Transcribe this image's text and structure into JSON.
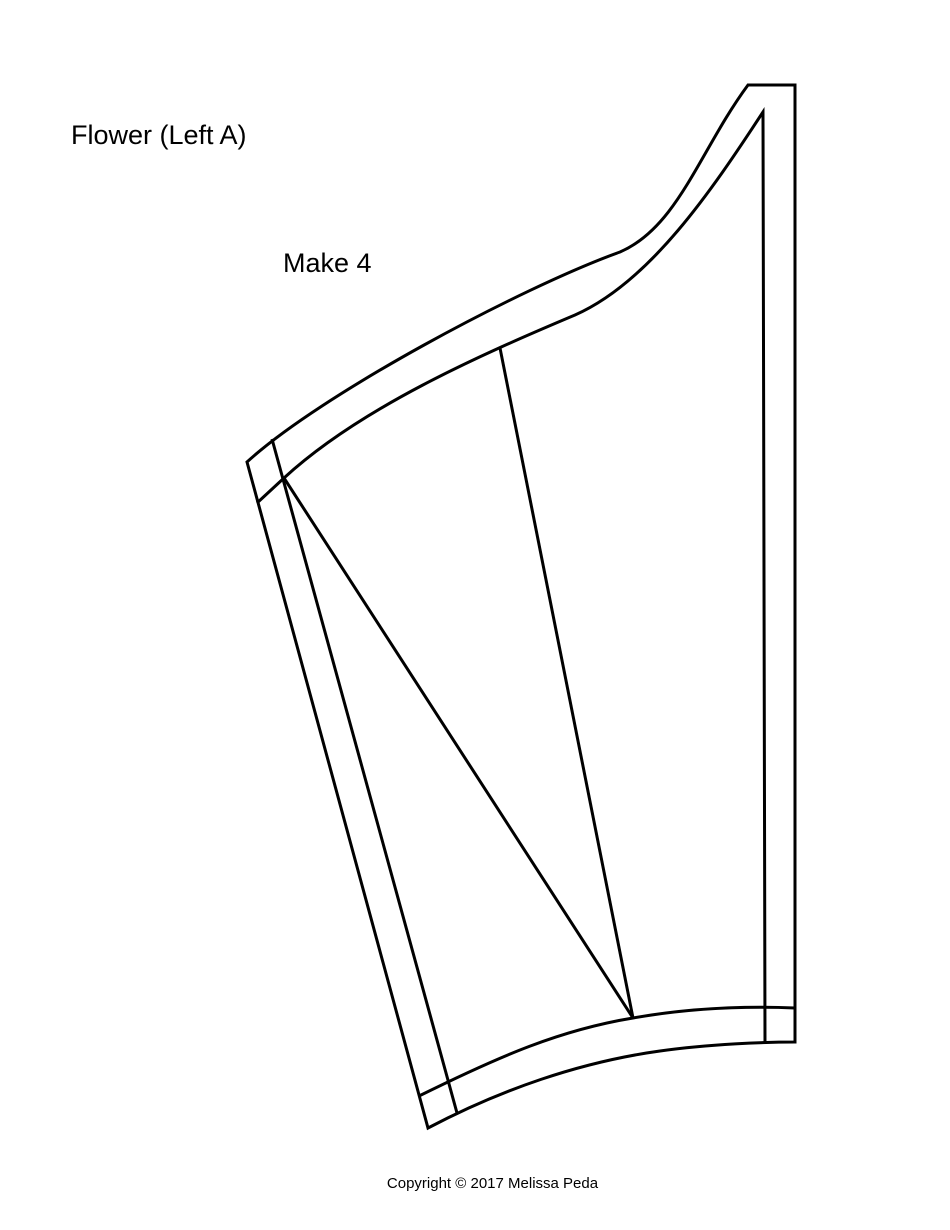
{
  "page": {
    "background": "#ffffff",
    "ink": "#000000"
  },
  "header": {
    "title": "Flower (Left A)",
    "instruction": "Make 4"
  },
  "footer": {
    "copyright": "Copyright © 2017 Melissa Peda"
  }
}
